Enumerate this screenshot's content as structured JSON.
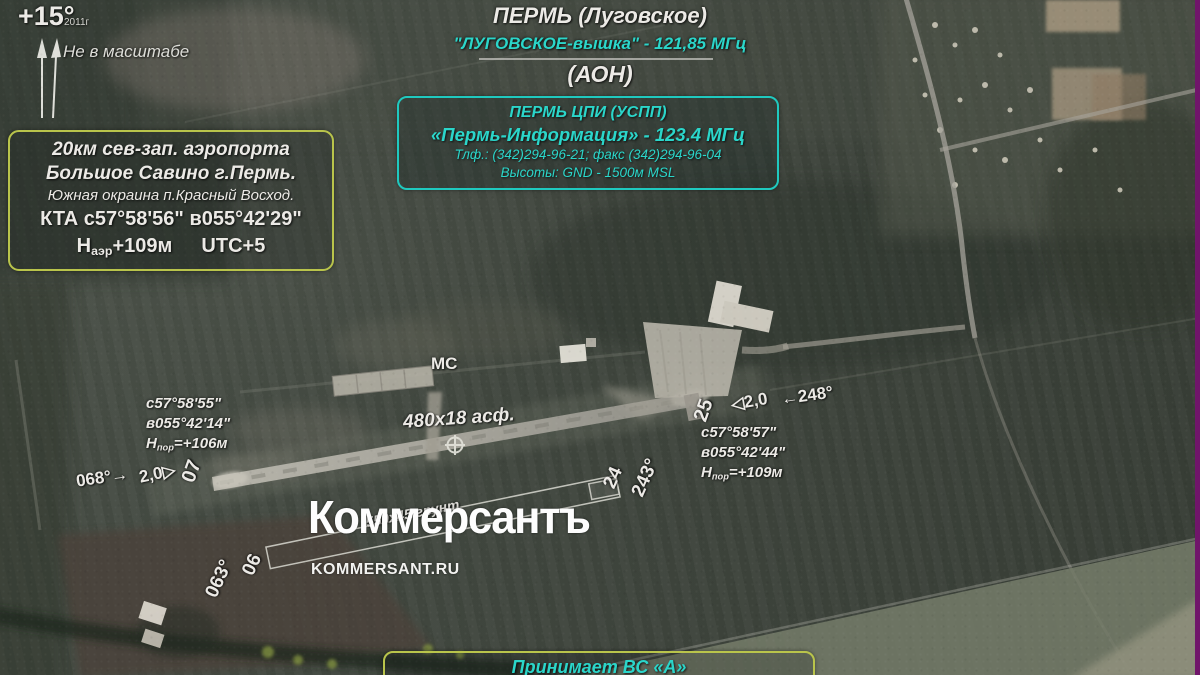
{
  "colors": {
    "accent": "#2bd6ca",
    "frame": "#b9c44b",
    "edge_stripe": "#70156a"
  },
  "header": {
    "title": "ПЕРМЬ (Луговское)",
    "tower": "\"ЛУГОВСКОЕ-вышка\" - 121,85 МГц",
    "aon": "(АОН)"
  },
  "cpi_box": {
    "l1": "ПЕРМЬ ЦПИ (УСПП)",
    "l2": "«Пермь-Информация» -  123.4 МГц",
    "l3": "Тлф.: (342)294-96-21; факс (342)294-96-04",
    "l4": "Высоты: GND - 1500м MSL"
  },
  "loc_box": {
    "l1": "20км сев-зап. аэропорта",
    "l2": "Большое Савино г.Пермь.",
    "l3": "Южная окраина п.Красный Восход.",
    "kta": "КТА с57°58'56\" в055°42'29\"",
    "h_prefix": "Н",
    "h_sub": "аэр",
    "h_value": "+109м",
    "utc": "UTC+5"
  },
  "compass": {
    "declination": "+15°",
    "year": "2011г",
    "note": "Не в масштабе"
  },
  "airfield": {
    "ms": "МС",
    "rwy_size": "480x18 асф.",
    "grass_size": "550x45 грунт",
    "thr07": {
      "num": "07",
      "course": "068°→",
      "dist": "2,0▷",
      "lat": "с57°58'55\"",
      "lon": "в055°42'14\"",
      "h_prefix": "Н",
      "h_sub": "пор",
      "h_value": "=+106м"
    },
    "thr25": {
      "num": "25",
      "course": "←248°",
      "dist": "◁2,0",
      "lat": "с57°58'57\"",
      "lon": "в055°42'44\"",
      "h_prefix": "Н",
      "h_sub": "пор",
      "h_value": "=+109м"
    },
    "thr24": {
      "num": "24",
      "course": "243°"
    },
    "thr06": {
      "num": "06",
      "course": "063°"
    }
  },
  "footer": {
    "accepts": "Принимает ВС «А»"
  },
  "watermark": {
    "logo": "Коммерсантъ",
    "site": "KOMMERSANT.RU"
  }
}
